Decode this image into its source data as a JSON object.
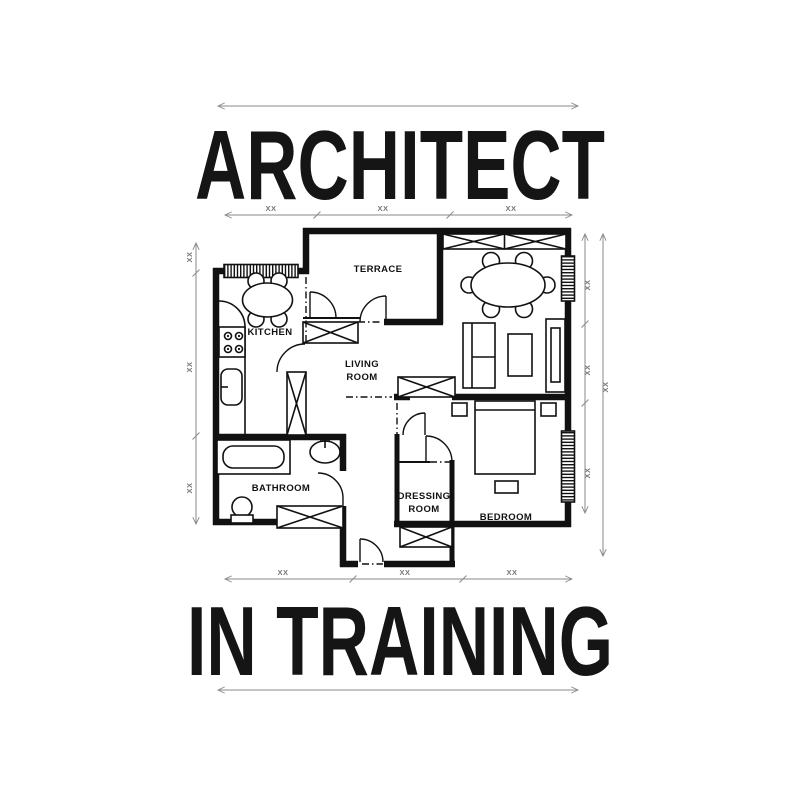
{
  "design": {
    "title_top": "ARCHITECT",
    "title_bottom": "IN TRAINING"
  },
  "dimension_label": "XX",
  "rooms": {
    "terrace": "TERRACE",
    "kitchen": "KITCHEN",
    "living_line1": "LIVING",
    "living_line2": "ROOM",
    "bathroom": "BATHROOM",
    "dressing_line1": "DRESSING",
    "dressing_line2": "ROOM",
    "bedroom": "BEDROOM"
  },
  "colors": {
    "ink": "#111111",
    "dimension_line": "#8a8a8a",
    "background": "#ffffff"
  }
}
